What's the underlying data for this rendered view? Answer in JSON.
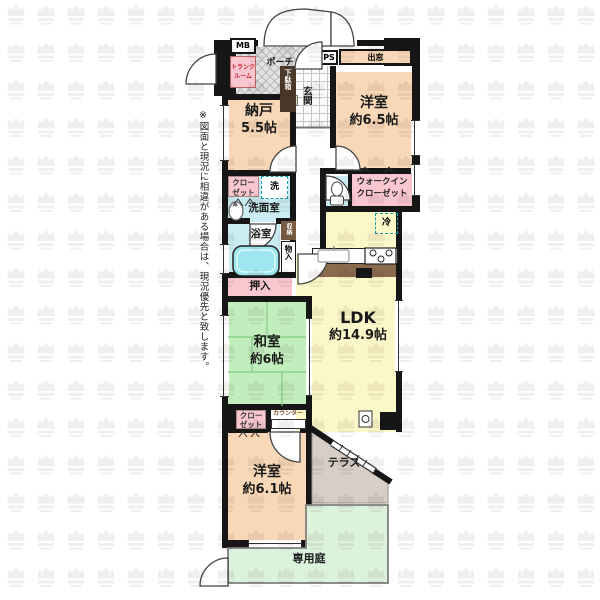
{
  "note": "※図面と現況に相違がある場合は、現況優先と致します。",
  "labels": {
    "porch": "ポーチ",
    "mb": "MB",
    "trunk_line1": "トランク",
    "trunk_line2": "ルーム",
    "ps": "PS",
    "bay_window": "出窓",
    "genkan": "玄関",
    "shoe_cabinet": "下駄箱",
    "nando_name": "納戸",
    "nando_size": "5.5帖",
    "west_room1_name": "洋室",
    "west_room1_size": "約6.5帖",
    "closet_line1": "クロー",
    "closet_line2": "ゼット",
    "washer": "洗",
    "washroom": "洗面室",
    "bath": "浴室",
    "storage": "収納",
    "cupboard": "物入",
    "wic_line1": "ウォークイン",
    "wic_line2": "クローゼット",
    "fridge": "冷",
    "oshiire": "押入",
    "ldk_name": "LDK",
    "ldk_size": "約14.9帖",
    "washitsu_name": "和室",
    "washitsu_size": "約6帖",
    "counter": "カウンター",
    "west_room2_name": "洋室",
    "west_room2_size": "約6.1帖",
    "terrace": "テラス",
    "garden": "専用庭"
  },
  "colors": {
    "wall": "#161616",
    "western_room": "#F8D8B6",
    "closet": "#F8C7D0",
    "wet_area": "#C9EDF3",
    "ldk": "#FAF7C8",
    "tatami": "#C2EDBD",
    "terrace": "#D7CFC5",
    "garden": "#DCF3DB",
    "watermark": "#7a6060"
  }
}
